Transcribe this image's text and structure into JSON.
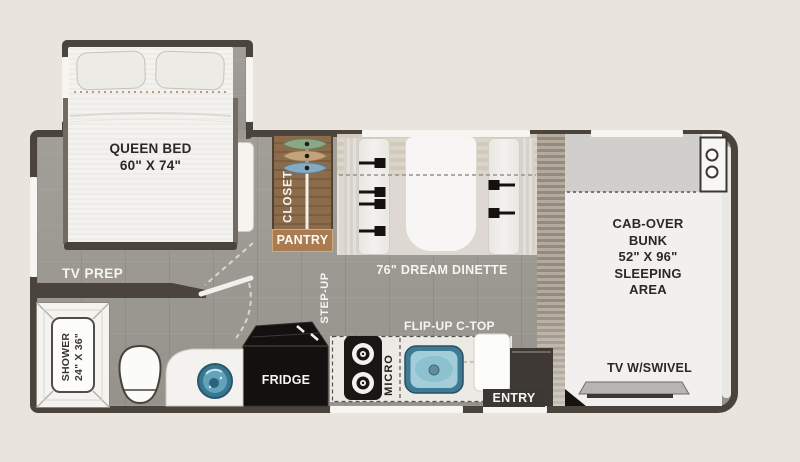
{
  "title": "RV floor plan",
  "colors": {
    "background": "#e9e5dd",
    "wall": "#4a443d",
    "floor_gray": "#9d9993",
    "closet_wood": "#8c6b4b",
    "pantry_tan": "#a87c50",
    "sink_blue": "#3f7a95",
    "bath_sink_blue": "#39768f",
    "appliance_black": "#131110",
    "bunk_white": "#f1f0ee"
  },
  "rooms": {
    "bedroom": {
      "bed": "QUEEN BED",
      "bed_size": "60\" X 74\"",
      "tv_prep": "TV PREP"
    },
    "closet": {
      "closet": "CLOSET",
      "pantry": "PANTRY"
    },
    "living": {
      "dinette": "76\" DREAM DINETTE",
      "step_up": "STEP-UP"
    },
    "kitchen": {
      "fridge": "FRIDGE",
      "micro": "MICRO",
      "flip_up": "FLIP-UP C-TOP",
      "entry": "ENTRY"
    },
    "bath": {
      "shower_text": "SHOWER\n24\" X 36\""
    },
    "cab": {
      "bunk_text": "CAB-OVER\nBUNK\n52\" X 96\"\nSLEEPING\nAREA",
      "tv": "TV W/SWIVEL"
    }
  }
}
